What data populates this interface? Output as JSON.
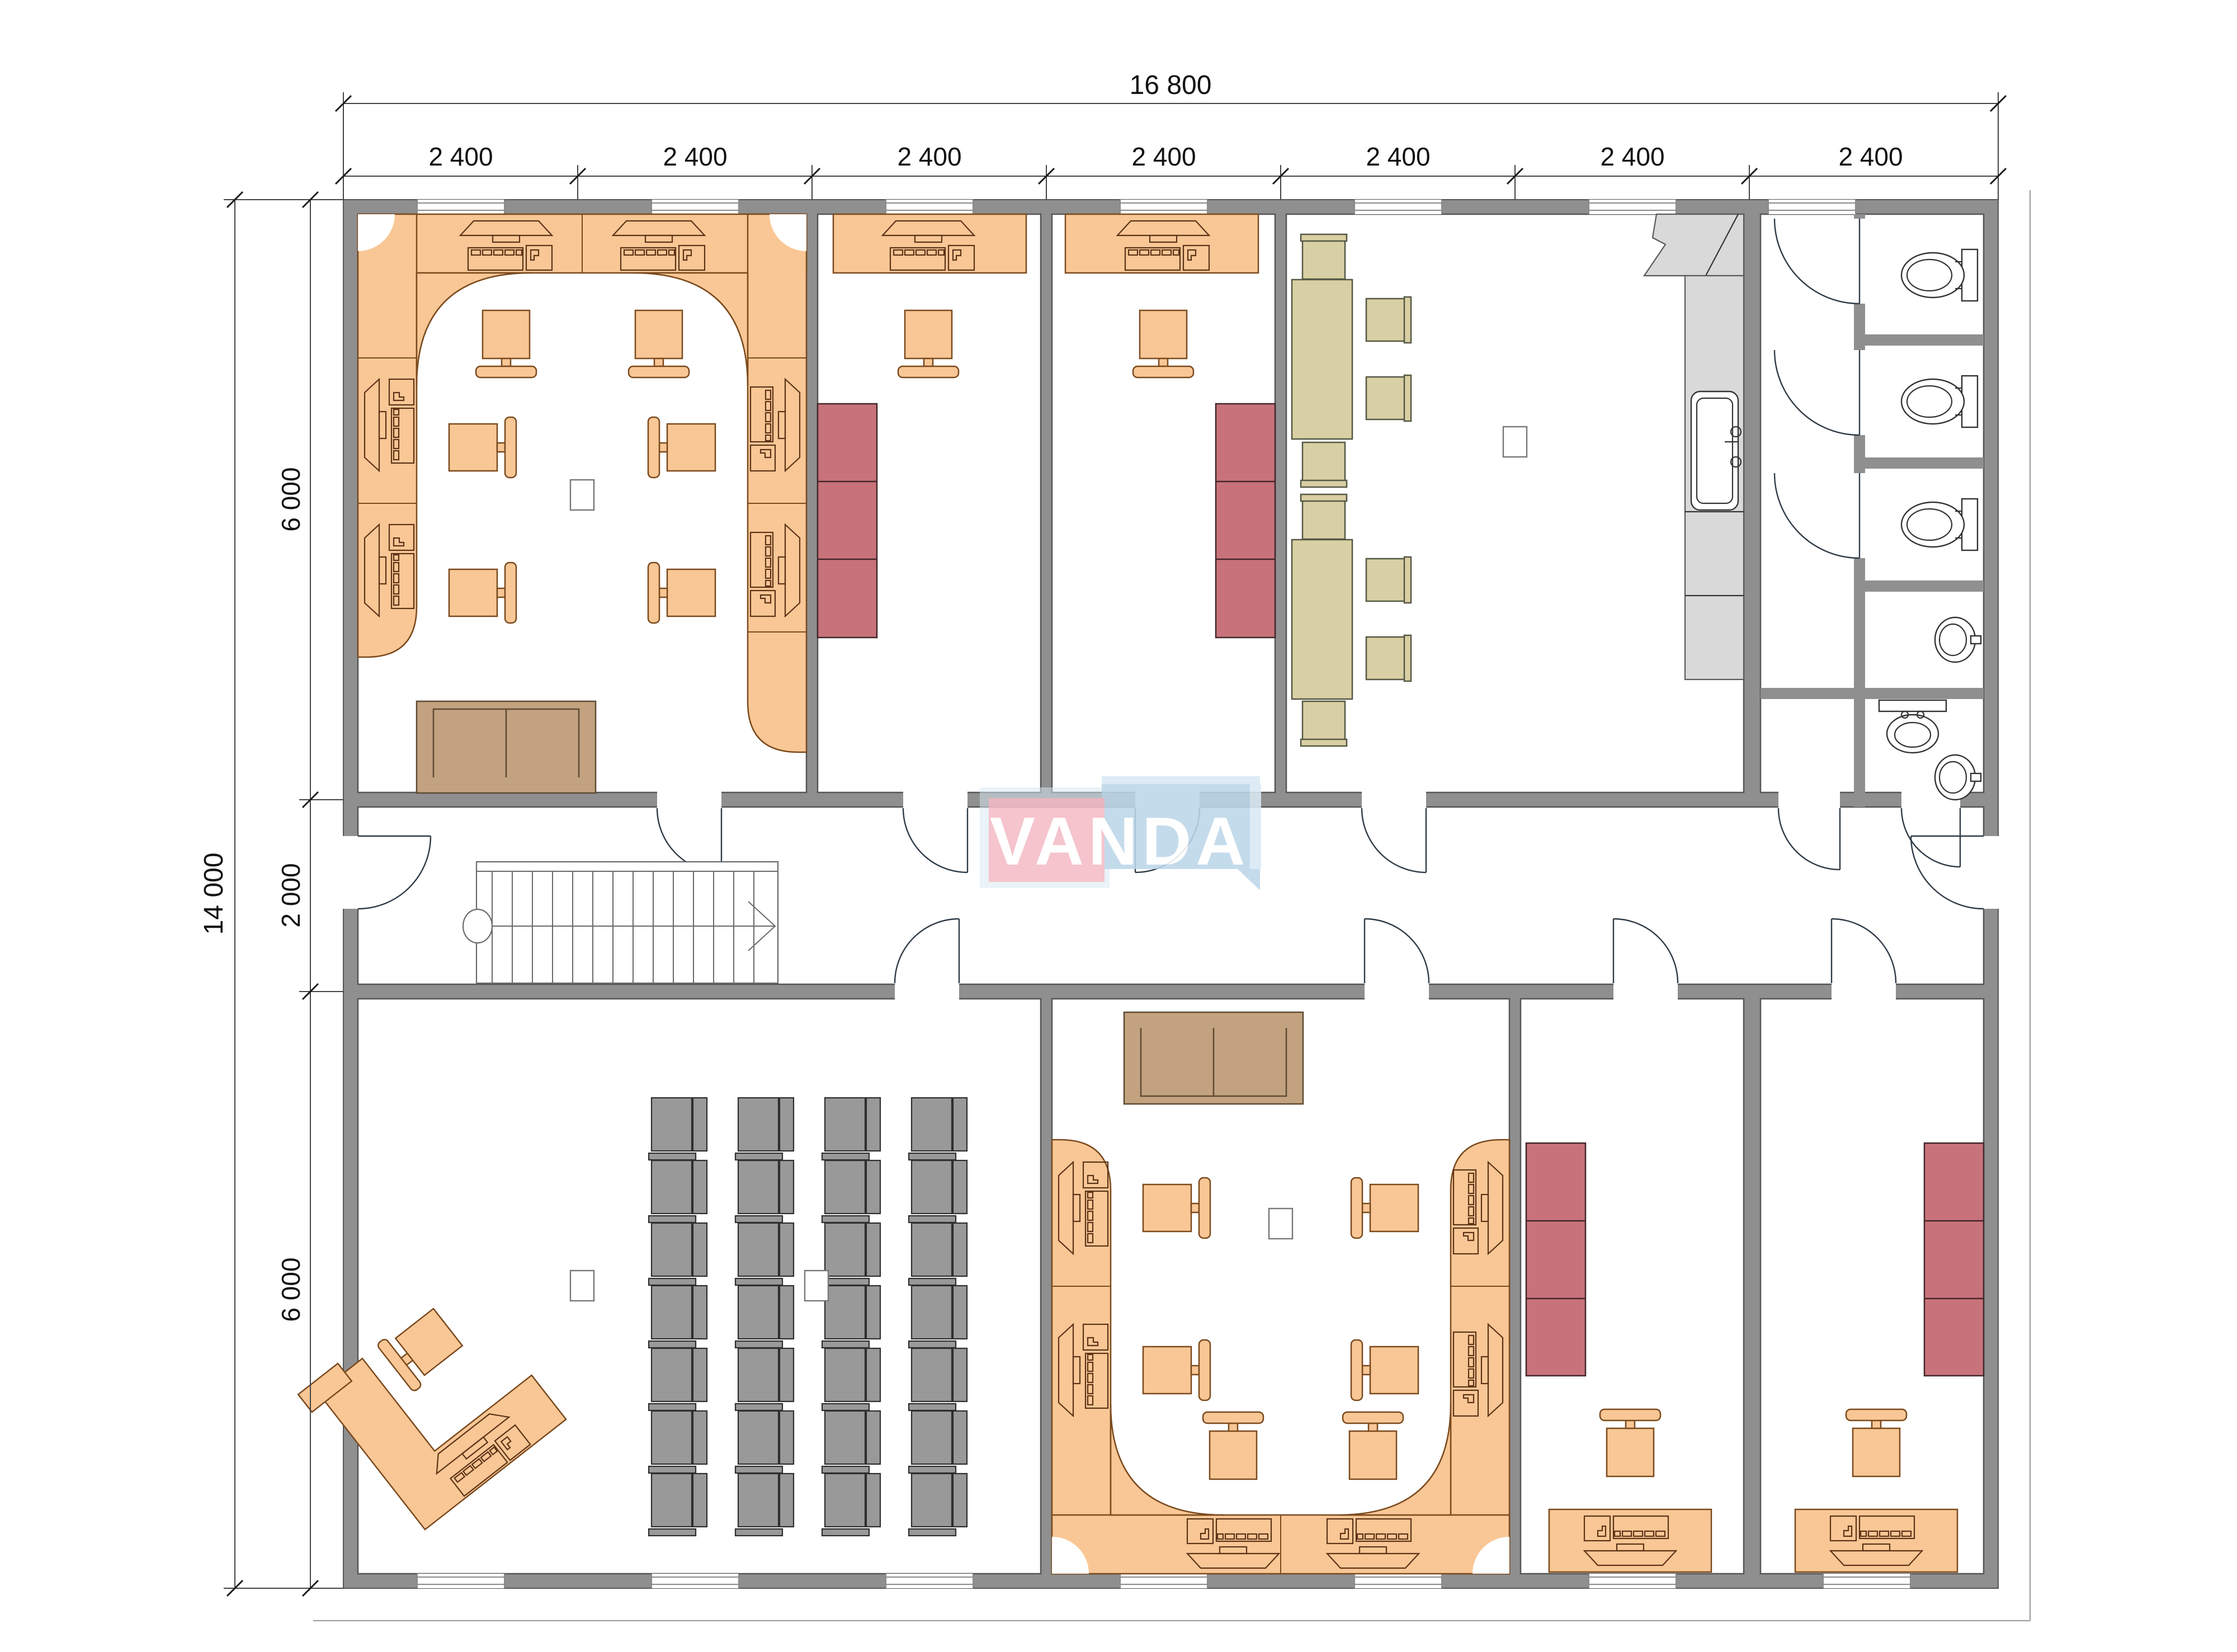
{
  "drawing": {
    "watermark_text": "VANDA",
    "dims_top": {
      "total": "16 800",
      "segments": [
        "2 400",
        "2 400",
        "2 400",
        "2 400",
        "2 400",
        "2 400",
        "2 400"
      ]
    },
    "dims_left": {
      "total": "14 000",
      "segments": [
        "6 000",
        "2 000",
        "6 000"
      ]
    }
  },
  "colors": {
    "wall": "#8f8f8f",
    "wall_edge": "#565656",
    "desk": "#f9c795",
    "desk_stroke": "#7a4a1e",
    "glyph_stroke": "#5c3317",
    "cabinet": "#c8737b",
    "cabinet_stroke": "#43272b",
    "sofa": "#c2a27f",
    "sofa_stroke": "#5e4a34",
    "table_beige": "#d9cfa4",
    "beige_stroke": "#555844",
    "chair_gray": "#999999",
    "gray_stroke": "#2e2e2e",
    "counter": "#d9d9d9",
    "counter_stroke": "#5a5a5a",
    "fixture_stroke": "#333333",
    "dim_text": "#111111",
    "dim_line": "#444444",
    "wm_pink": "#f4bcc7",
    "wm_blue": "#bcd7ea",
    "wm_blue_light": "#d8e9f4",
    "wm_text": "#ffffff"
  }
}
